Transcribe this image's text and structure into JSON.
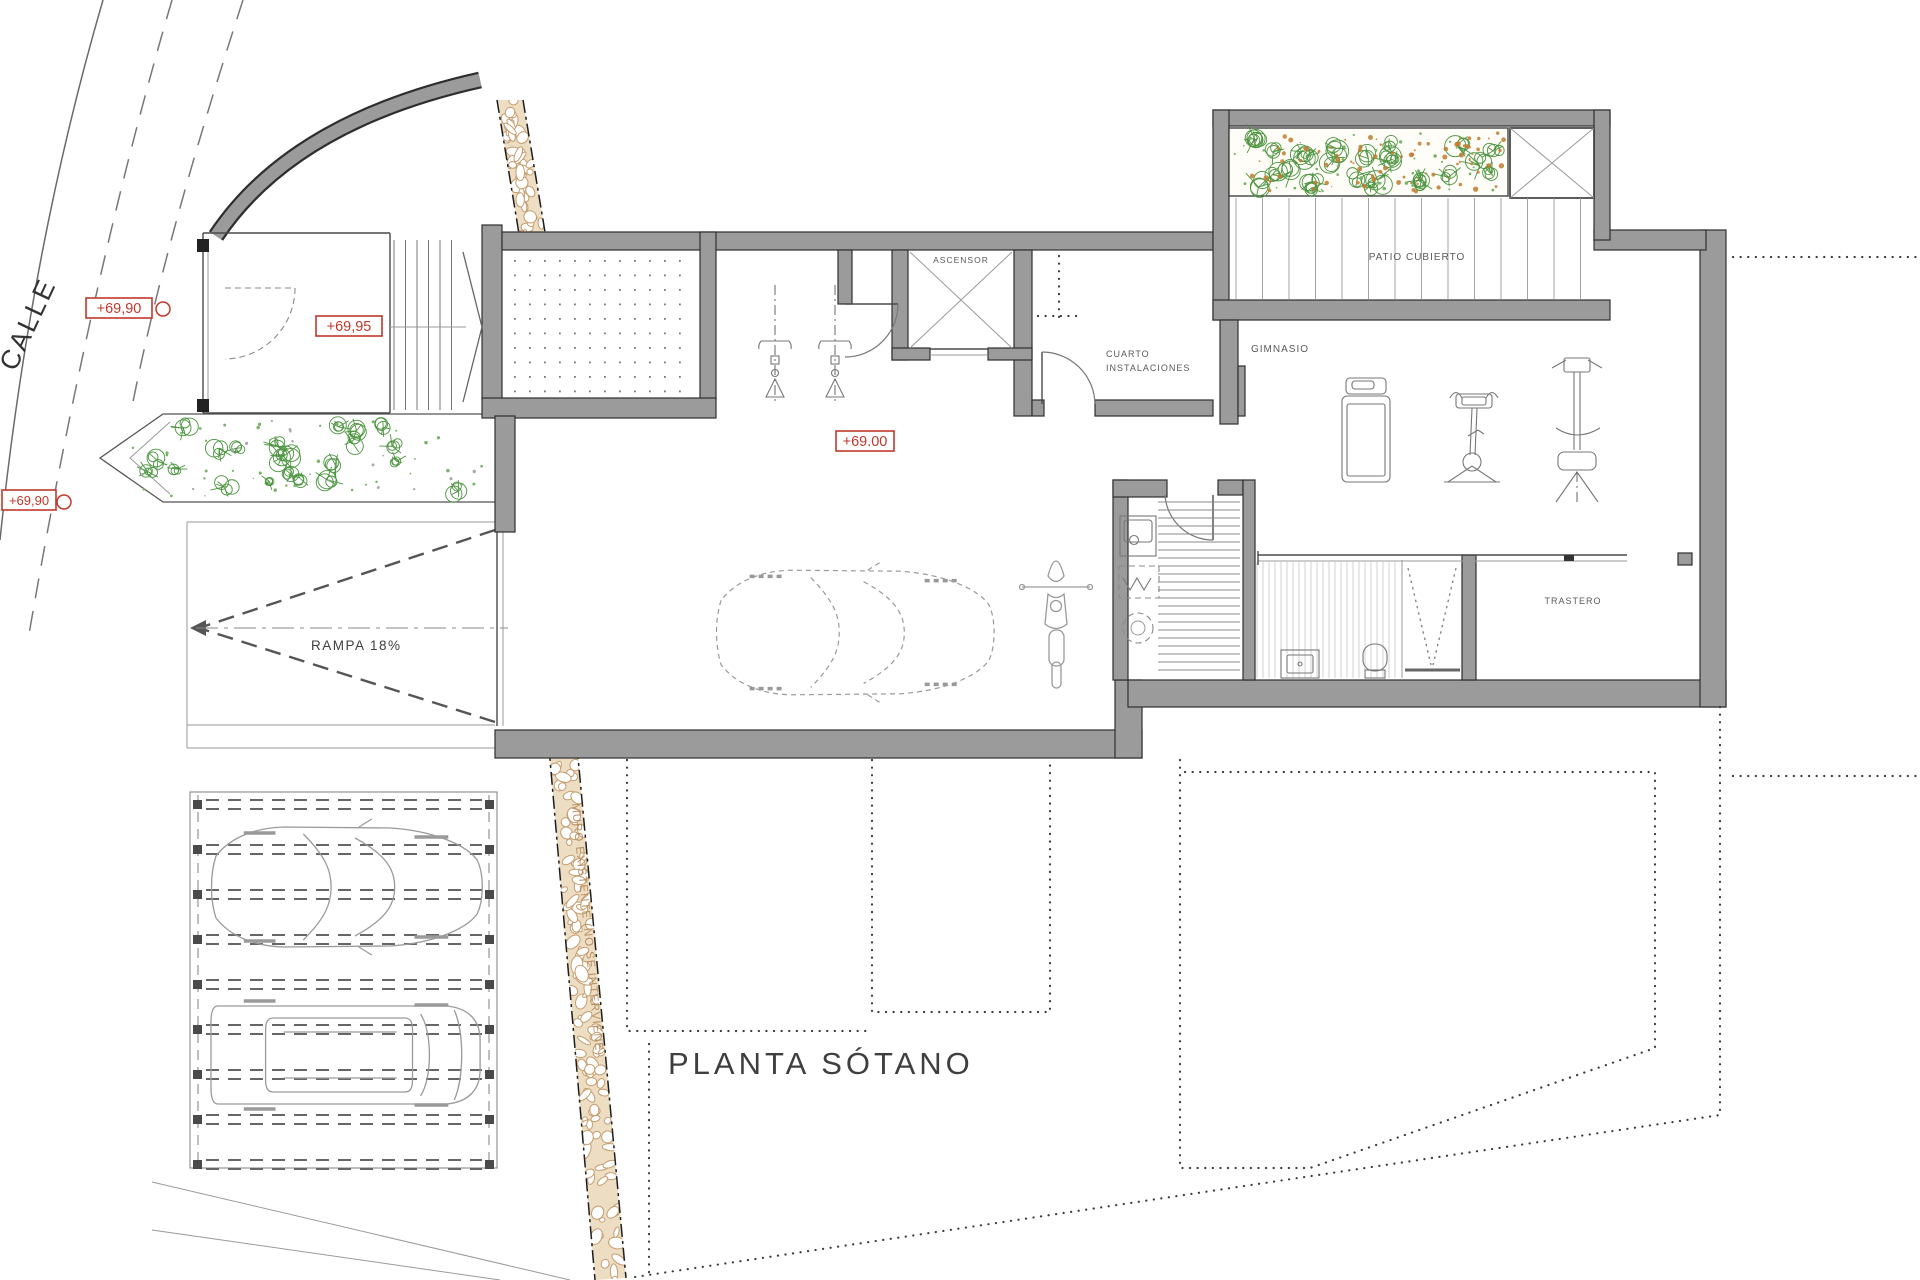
{
  "drawing": {
    "title": "PLANTA SÓTANO",
    "street_label": "CALLE",
    "existing_wall_label": "MURO EXISTENTE (NO SE INTERVIENE)",
    "ramp_label": "RAMPA  18%"
  },
  "rooms": {
    "elevator": "ASCENSOR",
    "utility_room_line1": "CUARTO",
    "utility_room_line2": "INSTALACIONES",
    "gym": "GIMNASIO",
    "covered_patio": "PATIO CUBIERTO",
    "storage_room": "TRASTERO"
  },
  "level_markers": {
    "street_upper": "+69,90",
    "entry": "+69,95",
    "street_lower": "+69,90",
    "garage_floor": "+69.00"
  },
  "colors": {
    "wall_fill": "#9b9b9b",
    "wall_outline": "#2e2e2e",
    "marker_red": "#c0392b",
    "plant_green": "#4c9440",
    "plant_dot_green": "#7ab36a",
    "mulch_orange": "#bf7d2f",
    "stone_fill": "#ecddc3",
    "stone_outline": "#c59d6e",
    "label_gray": "#555555"
  }
}
